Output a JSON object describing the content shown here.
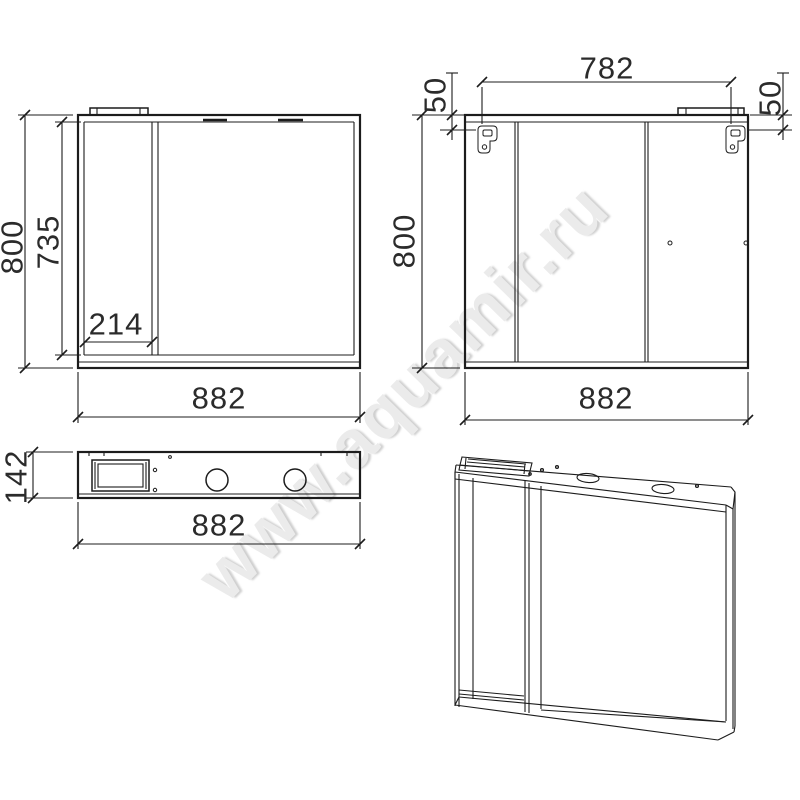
{
  "watermark": "www.aquamir.ru",
  "dims": {
    "front_height": "800",
    "front_inner_height": "735",
    "front_door_width": "214",
    "front_width": "882",
    "back_top_width": "782",
    "back_left_offset": "50",
    "back_right_offset": "50",
    "back_height": "800",
    "back_width": "882",
    "plan_depth": "142",
    "plan_width": "882"
  }
}
